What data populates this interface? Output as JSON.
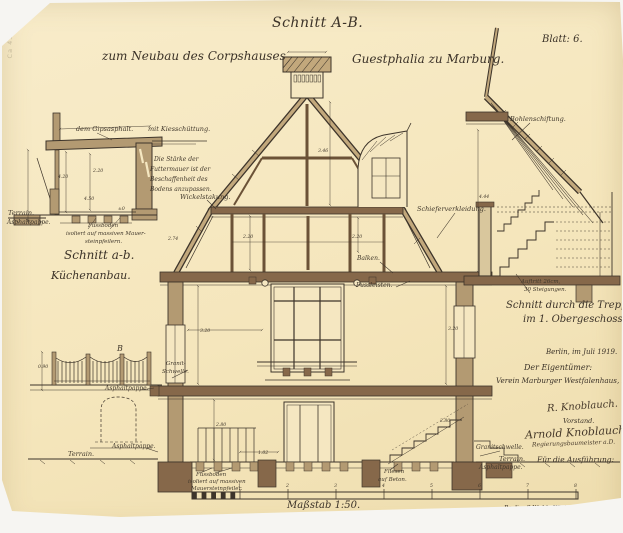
{
  "page": {
    "sheet_title": "Schnitt A-B.",
    "subtitle_left": "zum Neubau des Corpshauses",
    "subtitle_right": "Guestphalia zu Marburg.",
    "sheet_number": "Blatt: 6.",
    "scale_label": "Maßstab 1:50.",
    "printer_note": "Berlin, S.W. 11, Königgrätzerstrasse.",
    "stamp_text": "Ca 457/90"
  },
  "titles": {
    "kitchen_section_title": "Schnitt a-b.",
    "kitchen_section_subtitle": "Küchenanbau.",
    "stair_section_title_line1": "Schnitt durch die Treppe",
    "stair_section_title_line2": "im 1. Obergeschoss."
  },
  "signature_block": {
    "date": "Berlin, im Juli 1919.",
    "owner_heading": "Der Eigentümer:",
    "owner_name": "Verein Marburger Westfalenhaus, E.V.",
    "signature1": "R. Knoblauch.",
    "signature1_role": "Vorstand.",
    "signature2": "Arnold Knoblauch",
    "signature2_role": "Regierungsbaumeister a.D.",
    "execution_heading": "Für die Ausführung:"
  },
  "annotations": [
    {
      "text": "dem Gipsasphalt.",
      "x": 76,
      "y": 126,
      "fs": 6.5
    },
    {
      "text": "mit Kiesschüttung.",
      "x": 148,
      "y": 126,
      "fs": 6.5
    },
    {
      "text": "Die Stärke der",
      "x": 154,
      "y": 157,
      "fs": 6
    },
    {
      "text": "Futtermauer ist der",
      "x": 150,
      "y": 167,
      "fs": 6
    },
    {
      "text": "Beschaffenheit des",
      "x": 150,
      "y": 177,
      "fs": 6
    },
    {
      "text": "Bodens anzupassen.",
      "x": 150,
      "y": 187,
      "fs": 6
    },
    {
      "text": "Terrain.",
      "x": 8,
      "y": 210,
      "fs": 6.5
    },
    {
      "text": "Asphaltpappe.",
      "x": 7,
      "y": 220,
      "fs": 6
    },
    {
      "text": "Fussboden",
      "x": 88,
      "y": 224,
      "fs": 5.5
    },
    {
      "text": "isoliert auf massiven Mauer-",
      "x": 66,
      "y": 232,
      "fs": 5.5
    },
    {
      "text": "steinpfeilern.",
      "x": 85,
      "y": 240,
      "fs": 5.5
    },
    {
      "text": "Wickelstakung.",
      "x": 180,
      "y": 194,
      "fs": 6.5
    },
    {
      "text": "Balken.",
      "x": 357,
      "y": 256,
      "fs": 6
    },
    {
      "text": "Fussleisten.",
      "x": 356,
      "y": 283,
      "fs": 6
    },
    {
      "text": "Schieferverkleidung.",
      "x": 417,
      "y": 206,
      "fs": 6.5
    },
    {
      "text": "Bohlenschiftung.",
      "x": 510,
      "y": 116,
      "fs": 6.5
    },
    {
      "text": "Auftritt 26cm,",
      "x": 521,
      "y": 280,
      "fs": 5.5
    },
    {
      "text": "30 Steigungen.",
      "x": 524,
      "y": 288,
      "fs": 5.5
    },
    {
      "text": "Granit-",
      "x": 166,
      "y": 362,
      "fs": 5.5
    },
    {
      "text": "Schwelle.",
      "x": 162,
      "y": 370,
      "fs": 5.5
    },
    {
      "text": "Asphaltpappe.",
      "x": 105,
      "y": 386,
      "fs": 6
    },
    {
      "text": "Asphaltpappe.",
      "x": 112,
      "y": 444,
      "fs": 6
    },
    {
      "text": "Terrain.",
      "x": 68,
      "y": 451,
      "fs": 6.5
    },
    {
      "text": "Granitschwelle.",
      "x": 476,
      "y": 445,
      "fs": 6
    },
    {
      "text": "Terrain.",
      "x": 499,
      "y": 456,
      "fs": 6.5
    },
    {
      "text": "Asphaltpappe.",
      "x": 479,
      "y": 465,
      "fs": 6
    },
    {
      "text": "Fliesen",
      "x": 384,
      "y": 470,
      "fs": 5.5
    },
    {
      "text": "auf Beton.",
      "x": 378,
      "y": 478,
      "fs": 5.5
    },
    {
      "text": "Fussboden",
      "x": 196,
      "y": 473,
      "fs": 5.5
    },
    {
      "text": "isoliert auf massiven",
      "x": 188,
      "y": 480,
      "fs": 5.5
    },
    {
      "text": "Mauersteinpfeiler.",
      "x": 191,
      "y": 487,
      "fs": 5.5
    },
    {
      "text": "B",
      "x": 117,
      "y": 345,
      "fs": 8
    }
  ],
  "dimensions": [
    {
      "text": "4.20",
      "x": 58,
      "y": 176
    },
    {
      "text": "4.50",
      "x": 84,
      "y": 198
    },
    {
      "text": "2.20",
      "x": 93,
      "y": 170
    },
    {
      "text": "2.74",
      "x": 168,
      "y": 238
    },
    {
      "text": "2.20",
      "x": 243,
      "y": 236
    },
    {
      "text": "3.46",
      "x": 318,
      "y": 150
    },
    {
      "text": "2.20",
      "x": 352,
      "y": 236
    },
    {
      "text": "3.20",
      "x": 200,
      "y": 330
    },
    {
      "text": "3.20",
      "x": 448,
      "y": 328
    },
    {
      "text": "2.80",
      "x": 216,
      "y": 424
    },
    {
      "text": "2.80",
      "x": 440,
      "y": 420
    },
    {
      "text": "1.02",
      "x": 258,
      "y": 452
    },
    {
      "text": "4.44",
      "x": 479,
      "y": 196
    },
    {
      "text": "0.90",
      "x": 38,
      "y": 366
    },
    {
      "text": "±0",
      "x": 118,
      "y": 208
    },
    {
      "text": "1",
      "x": 238,
      "y": 485
    },
    {
      "text": "2",
      "x": 286,
      "y": 485
    },
    {
      "text": "3",
      "x": 334,
      "y": 485
    },
    {
      "text": "4",
      "x": 382,
      "y": 485
    },
    {
      "text": "5",
      "x": 430,
      "y": 485
    },
    {
      "text": "6",
      "x": 478,
      "y": 485
    },
    {
      "text": "7",
      "x": 526,
      "y": 485
    },
    {
      "text": "8",
      "x": 574,
      "y": 485
    }
  ]
}
